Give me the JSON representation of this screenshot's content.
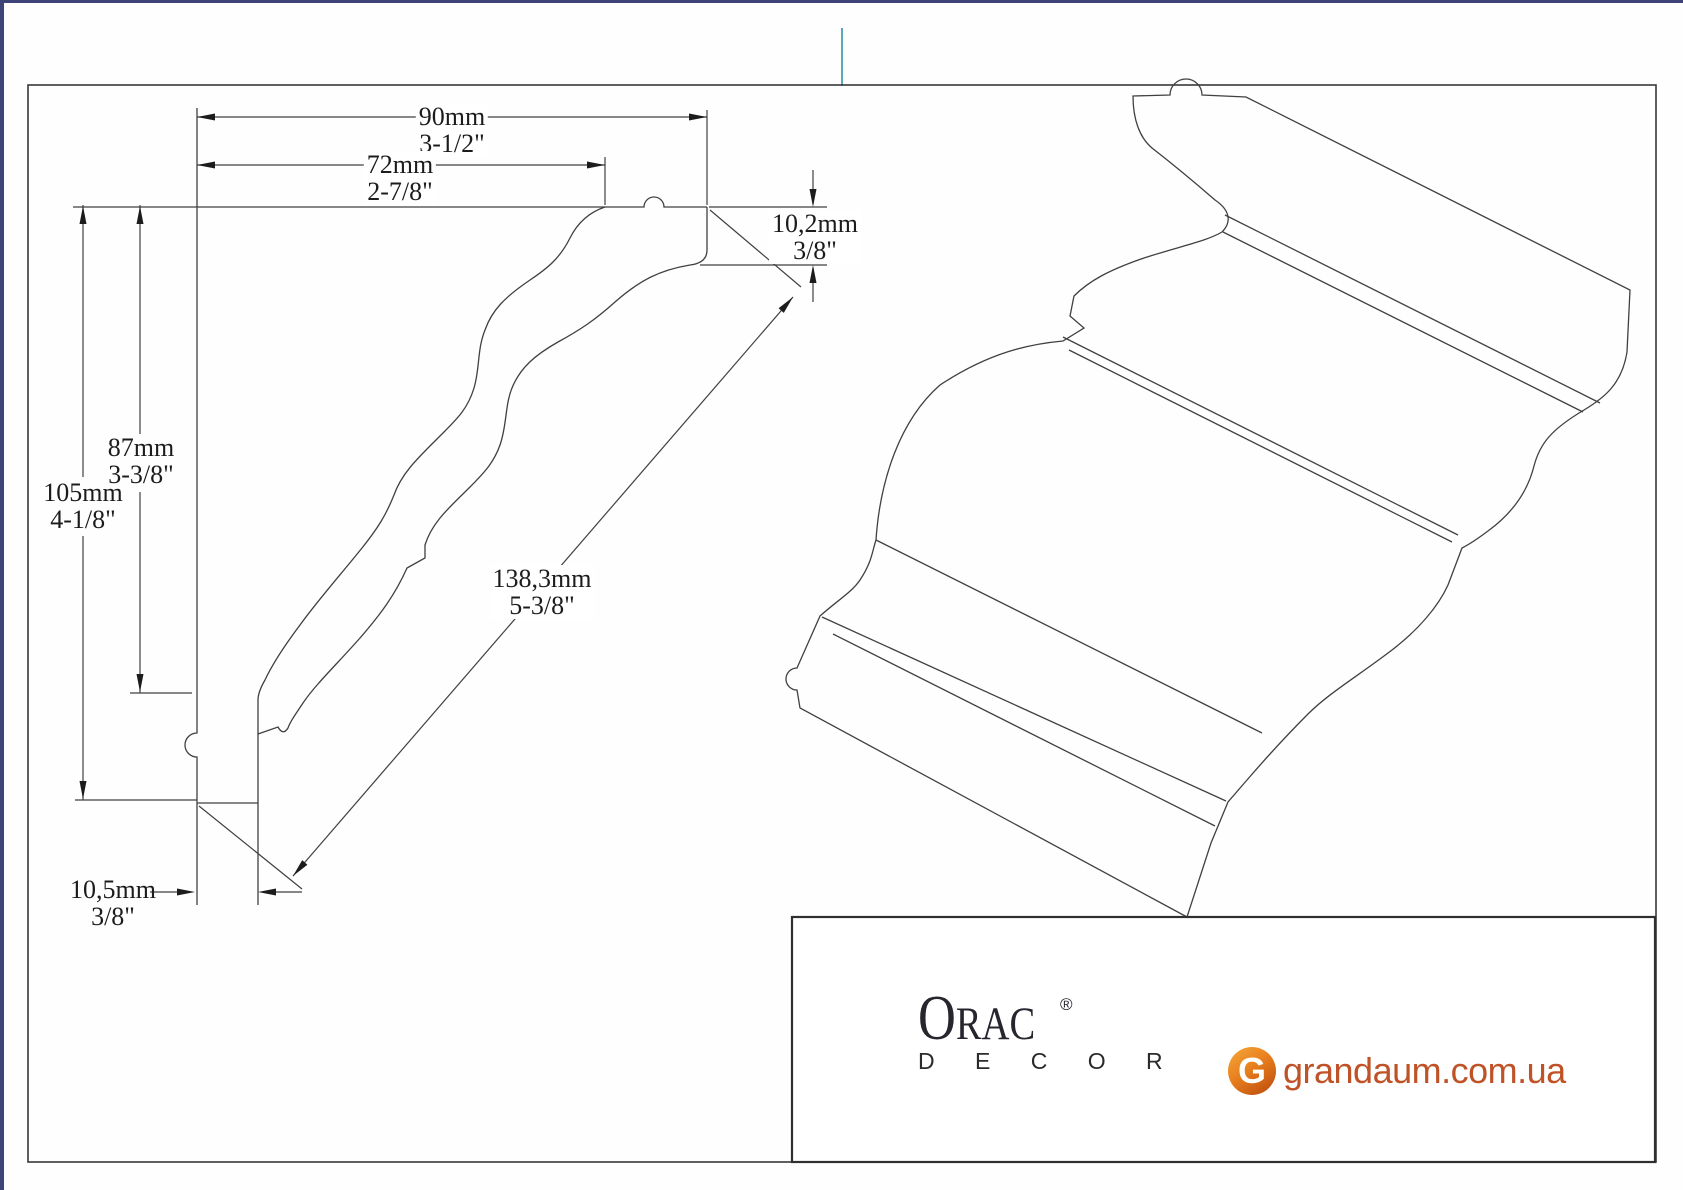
{
  "drawing": {
    "title_semantic": "crown-molding-profile-technical-drawing",
    "dimensions": {
      "total_width": {
        "mm": "90mm",
        "inch": "3-1/2\""
      },
      "inner_width": {
        "mm": "72mm",
        "inch": "2-7/8\""
      },
      "inner_height": {
        "mm": "87mm",
        "inch": "3-3/8\""
      },
      "total_height": {
        "mm": "105mm",
        "inch": "4-1/8\""
      },
      "top_thickness": {
        "mm": "10,2mm",
        "inch": "3/8\""
      },
      "face_length": {
        "mm": "138,3mm",
        "inch": "5-3/8\""
      },
      "bottom_thickness": {
        "mm": "10,5mm",
        "inch": "3/8\""
      }
    }
  },
  "footer": {
    "brand": {
      "initial": "O",
      "rest": "RAC",
      "registered": "®",
      "sub": "D E C O R"
    },
    "site": {
      "g": "G",
      "domain": "grandaum.com.ua"
    }
  },
  "colors": {
    "page_border_navy": "#3e4478",
    "tick_teal": "#5ba8b8",
    "drawing_line": "#404040",
    "brand_dark": "#26262e",
    "site_orange": "#bf5226"
  }
}
